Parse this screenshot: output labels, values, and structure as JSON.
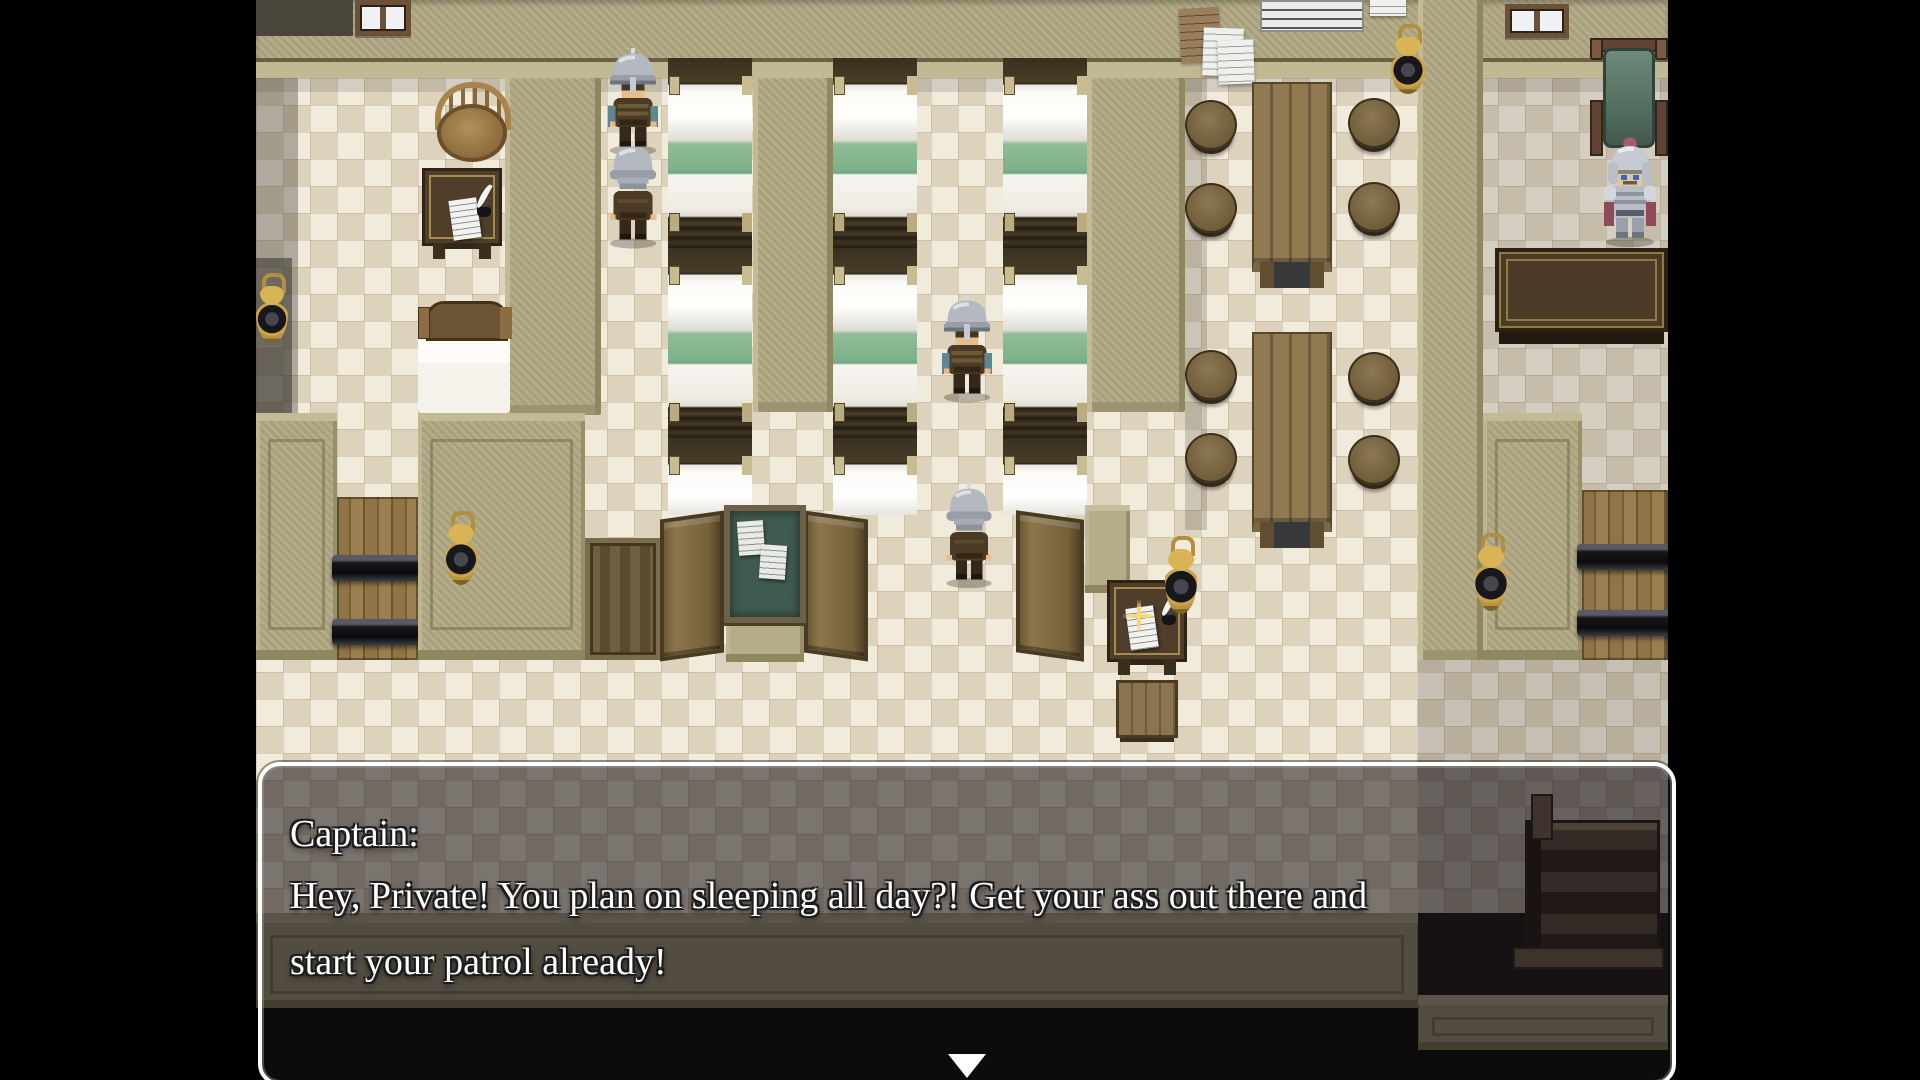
{
  "dialogue": {
    "speaker": "Captain:",
    "lines": [
      "Hey, Private! You plan on sleeping all day?! Get your ass out there and",
      "start your patrol already!"
    ],
    "continue_indicator": "down-triangle"
  },
  "scene": {
    "name": "castle-barracks-interior",
    "characters": [
      {
        "id": "soldier-left-front",
        "type": "soldier",
        "facing": "down"
      },
      {
        "id": "soldier-left-back",
        "type": "soldier",
        "facing": "up"
      },
      {
        "id": "soldier-center-front",
        "type": "soldier",
        "facing": "down"
      },
      {
        "id": "soldier-center-back",
        "type": "soldier",
        "facing": "up"
      },
      {
        "id": "captain-knight",
        "type": "knight",
        "facing": "down"
      }
    ],
    "furniture": [
      "bunk-beds",
      "dining-tables",
      "round-stools",
      "notice-board",
      "writing-desks",
      "wall-lanterns",
      "swinging-gates",
      "plank-gates",
      "staircase",
      "captain-chair",
      "captain-desk",
      "round-chair",
      "single-bed",
      "wall-papers",
      "wall-chart",
      "windows"
    ]
  },
  "colors": {
    "letterbox": "#000000",
    "floor_light": "#f1ebdc",
    "floor_dark": "#ddd3bd",
    "wall_tan": "#b1a984",
    "bed_blanket_green": "#8fbd97",
    "gate_wood": "#8f7448",
    "dialog_border": "#ffffff",
    "dialog_fill": "rgba(25,20,24,0.55)",
    "text": "#ffffff"
  }
}
